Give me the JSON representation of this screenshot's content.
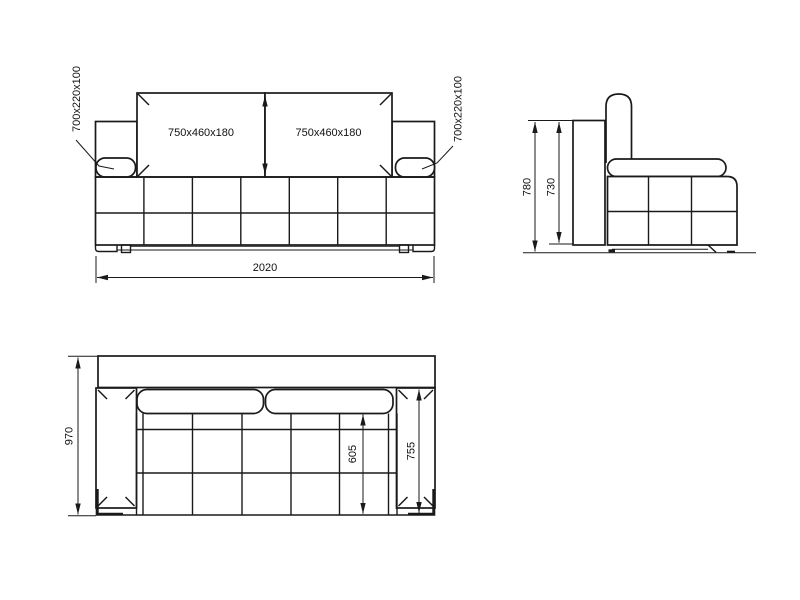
{
  "front_view": {
    "cushion_left_label": "750x460x180",
    "cushion_right_label": "750x460x180",
    "armrest_left_label": "700x220x100",
    "armrest_right_label": "700x220x100",
    "overall_width_label": "2020"
  },
  "side_view": {
    "overall_height_label": "780",
    "backrest_height_label": "730"
  },
  "top_view": {
    "overall_depth_label": "970",
    "seat_depth_label": "605",
    "armrest_length_label": "755"
  },
  "colors": {
    "line": "#1a1a1a",
    "background": "#ffffff"
  }
}
